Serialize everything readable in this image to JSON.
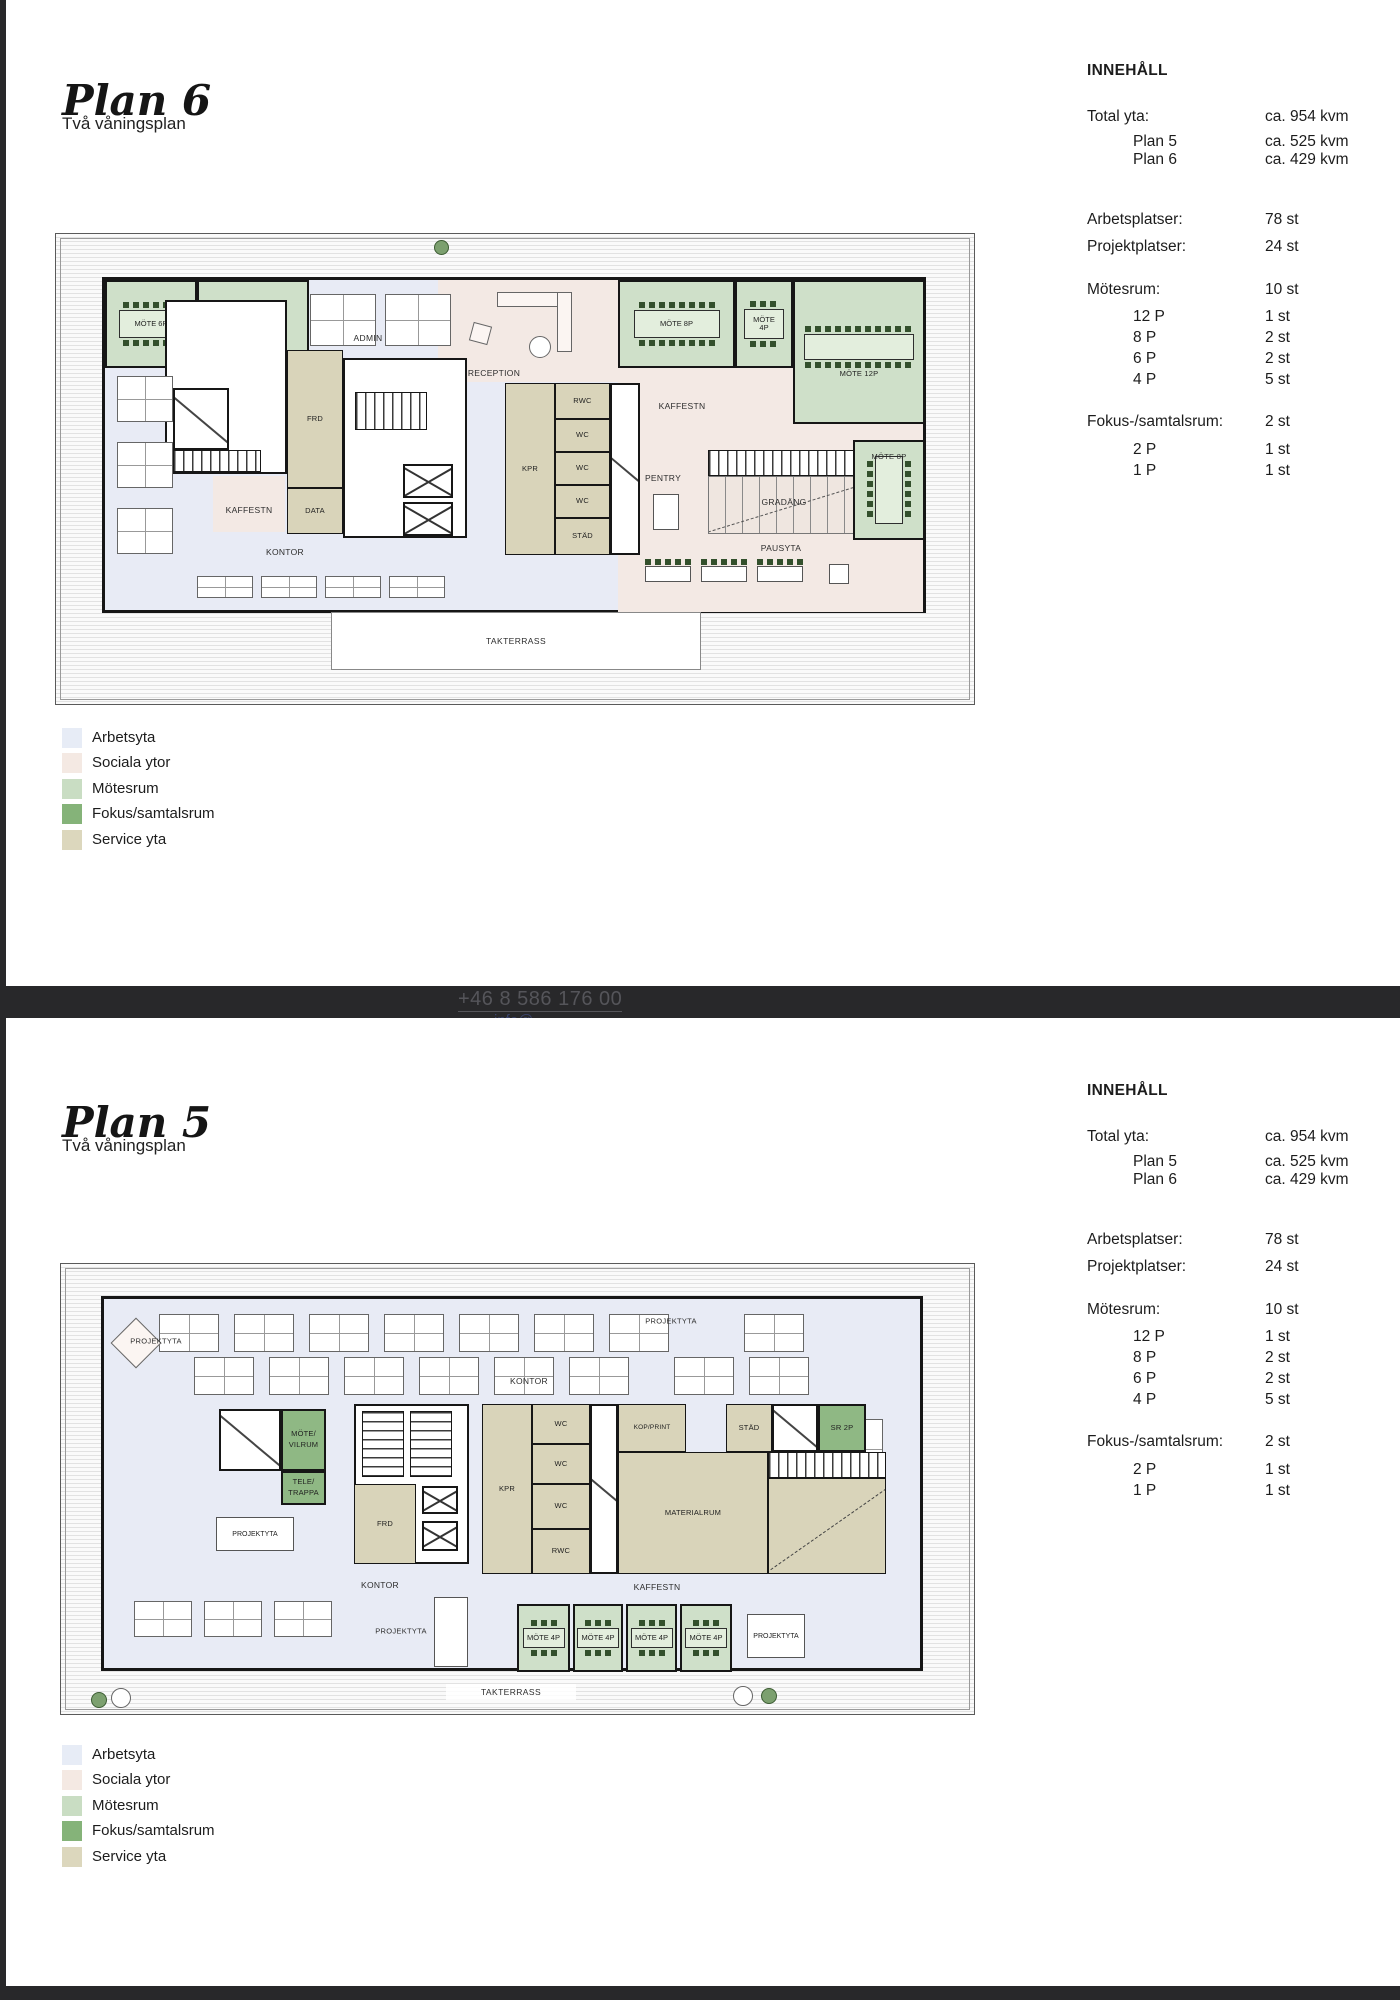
{
  "p1": {
    "title": "Plan 6",
    "subtitle": "Två våningsplan"
  },
  "p2": {
    "title": "Plan 5",
    "subtitle": "Två våningsplan"
  },
  "innehall": {
    "heading": "INNEHÅLL",
    "total_label": "Total yta:",
    "total_value": "ca. 954 kvm",
    "plan5_label": "Plan 5",
    "plan5_value": "ca. 525 kvm",
    "plan6_label": "Plan 6",
    "plan6_value": "ca. 429 kvm",
    "arbetsplatser_label": "Arbetsplatser:",
    "arbetsplatser_value": "78 st",
    "projektplatser_label": "Projektplatser:",
    "projektplatser_value": "24 st",
    "motesrum_label": "Mötesrum:",
    "motesrum_value": "10 st",
    "m12_label": "12 P",
    "m12_value": "1 st",
    "m8_label": "8 P",
    "m8_value": "2 st",
    "m6_label": "6 P",
    "m6_value": "2 st",
    "m4_label": "4 P",
    "m4_value": "5 st",
    "fokus_label": "Fokus-/samtalsrum:",
    "fokus_value": "2 st",
    "f2_label": "2 P",
    "f2_value": "1 st",
    "f1_label": "1 P",
    "f1_value": "1 st"
  },
  "legend": {
    "arbetsyta": "Arbetsyta",
    "sociala": "Sociala ytor",
    "motesrum": "Mötesrum",
    "fokus": "Fokus/samtalsrum",
    "service": "Service yta"
  },
  "colors": {
    "arbetsyta": "#e7ecf6",
    "sociala_ytor": "#f4e9e3",
    "motesrum": "#c9ddc3",
    "fokus_samtalsrum": "#85b379",
    "service_yta": "#dcd7bd",
    "wall": "#161616",
    "footer_band": "#28282a"
  },
  "plan6": {
    "labels": {
      "mote6p": "MÖTE 6P",
      "admin": "ADMIN",
      "reception": "RECEPTION",
      "mote8p": "MÖTE 8P",
      "mote4p_l1": "MÖTE",
      "mote4p_l2": "4P",
      "mote12p": "MÖTE 12P",
      "kaffestn": "KAFFESTN",
      "pentry": "PENTRY",
      "gradang": "GRADÄNG",
      "pausyta": "PAUSYTA",
      "rwc": "RWC",
      "wc": "WC",
      "stad": "STÄD",
      "kpr": "KPR",
      "frd": "FRD",
      "data": "DATA",
      "kontor": "KONTOR",
      "takterrass": "TAKTERRASS"
    }
  },
  "plan5": {
    "labels": {
      "projektyta": "PROJEKTYTA",
      "kontor": "KONTOR",
      "mote_vilrum_l1": "MÖTE/",
      "mote_vilrum_l2": "VILRUM",
      "tele_trappa_l1": "TELE/",
      "tele_trappa_l2": "TRAPPA",
      "frd": "FRD",
      "kpr": "KPR",
      "wc": "WC",
      "rwc": "RWC",
      "kop_print": "KOP/PRINT",
      "materialrum": "MATERIALRUM",
      "stad": "STÄD",
      "sr2p": "SR 2P",
      "kaffestn": "KAFFESTN",
      "mote4p": "MÖTE 4P",
      "takterrass": "TAKTERRASS"
    }
  },
  "footer": {
    "phone": "+46 8 586 176 00",
    "email_fragment": "info@"
  }
}
